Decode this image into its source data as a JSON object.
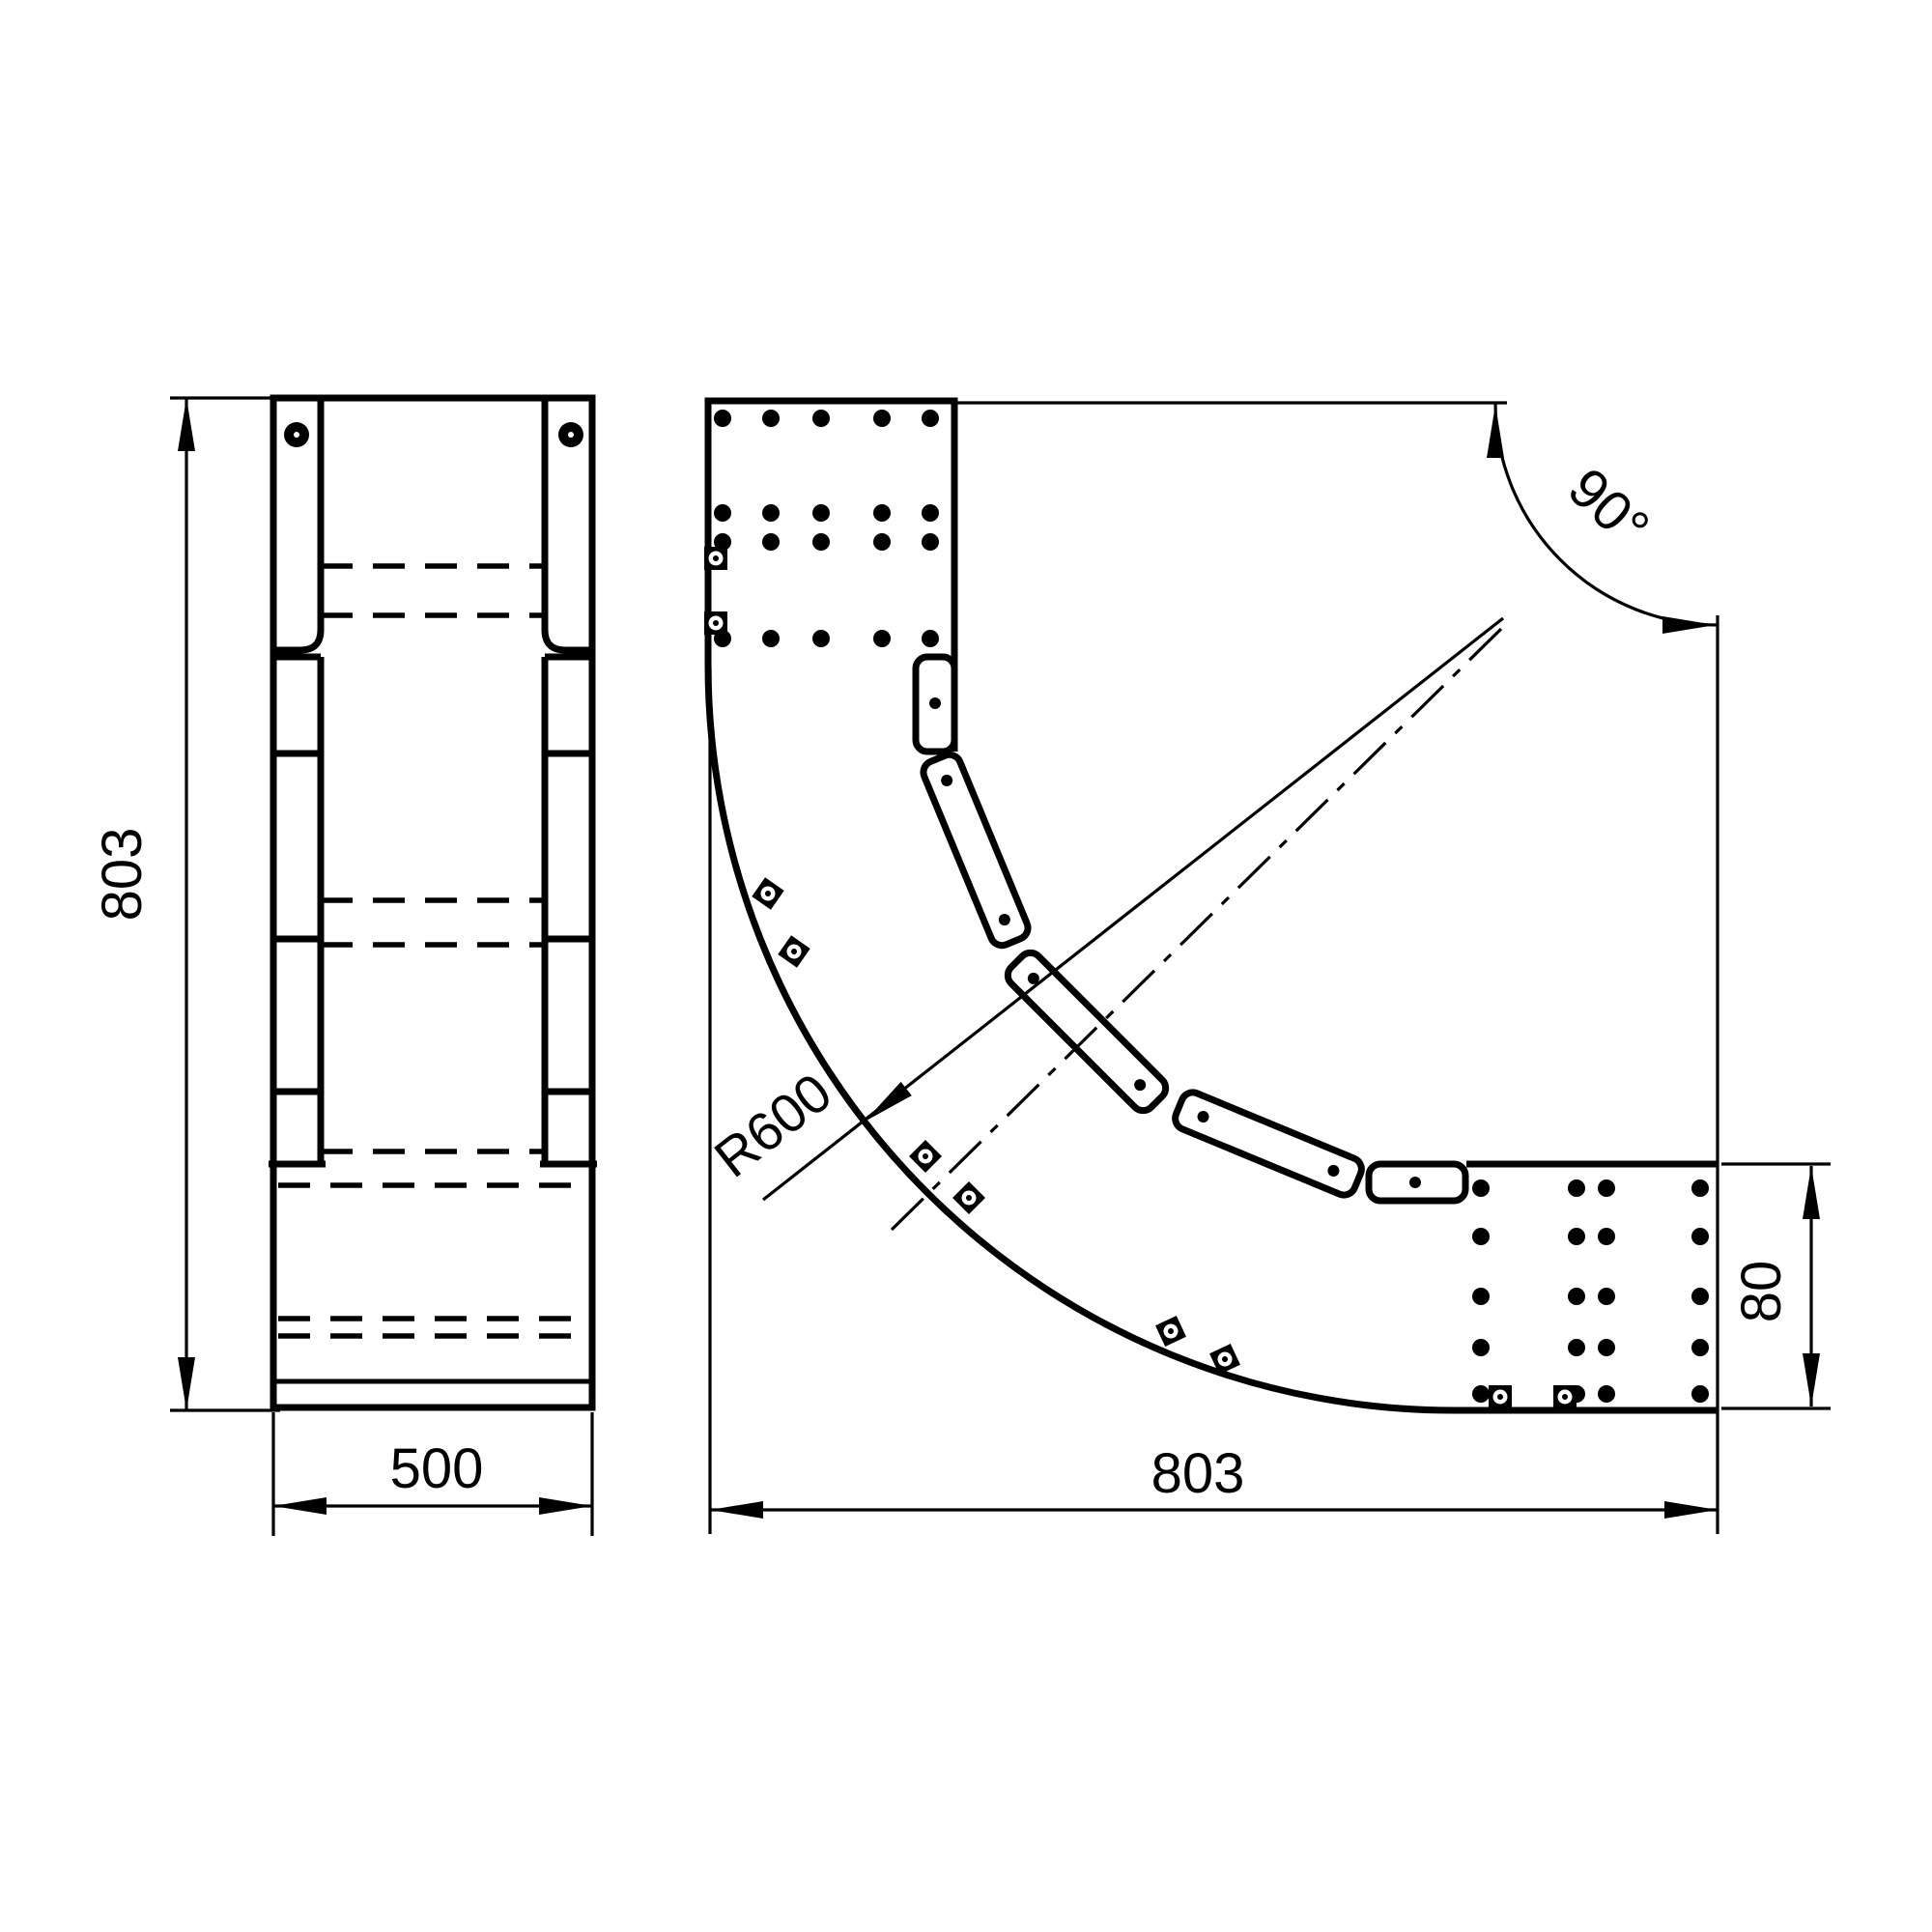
{
  "drawing": {
    "type": "technical-drawing",
    "description": "Cable tray 90 degree horizontal bend, two orthographic views",
    "colors": {
      "line": "#000000",
      "background": "#ffffff"
    },
    "views": {
      "side_view": {
        "height_dim": "803",
        "width_dim": "500"
      },
      "plan_view": {
        "angle_dim": "90°",
        "radius_dim": "R600",
        "end_height_dim": "80",
        "width_dim": "803"
      }
    }
  }
}
